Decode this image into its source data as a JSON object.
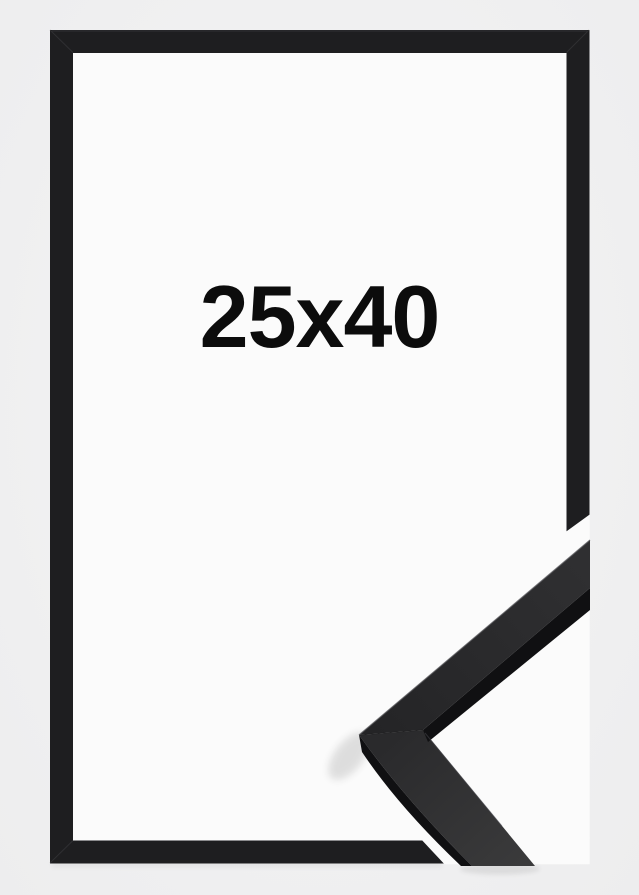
{
  "product": {
    "size_label": "25x40"
  },
  "colors": {
    "background": "#f0f0f1",
    "frame_black": "#1e1e20",
    "inner_white": "#fbfbfb",
    "label_text": "#0c0c0c",
    "profile_edge_dark": "#101012",
    "profile_face_upper": "#2a2a2c",
    "profile_face_lower": "#323234",
    "edge_highlight": "#55555a"
  }
}
